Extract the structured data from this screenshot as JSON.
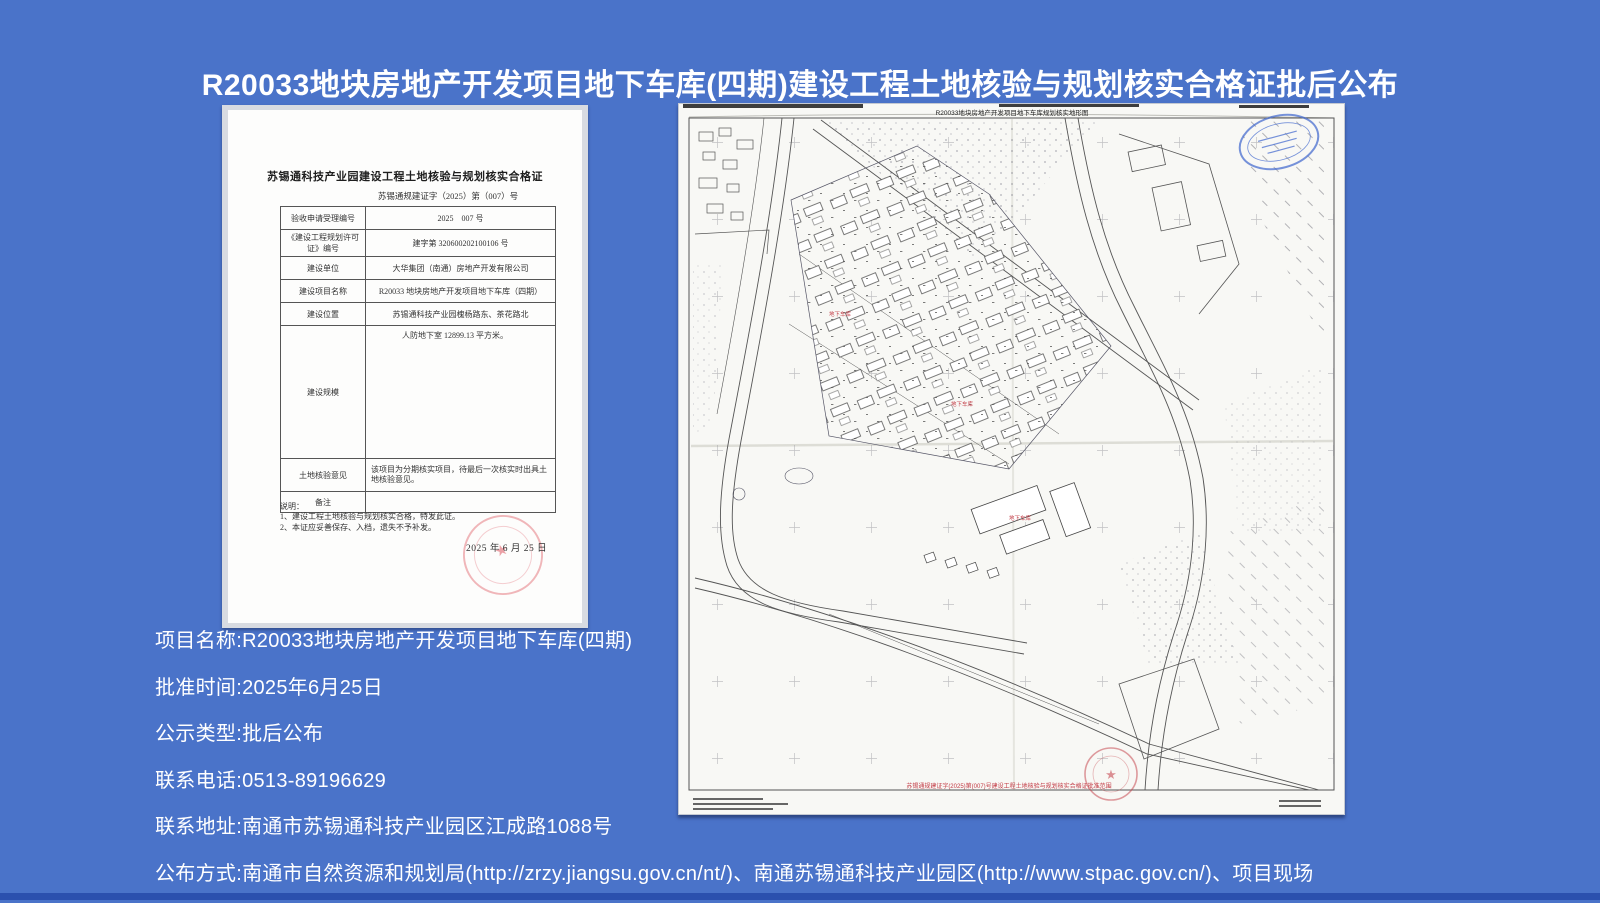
{
  "page": {
    "title": "R20033地块房地产开发项目地下车库(四期)建设工程土地核验与规划核实合格证批后公布",
    "background_color": "#4a73c9",
    "title_color": "#ffffff"
  },
  "certificate": {
    "title": "苏锡通科技产业园建设工程土地核验与规划核实合格证",
    "doc_number": "苏锡通规建证字（2025）第（007）号",
    "rows": [
      {
        "label": "验收申请受理编号",
        "value": "2025　007 号"
      },
      {
        "label": "《建设工程规划许可证》编号",
        "value": "建字第 320600202100106 号"
      },
      {
        "label": "建设单位",
        "value": "大华集团（南通）房地产开发有限公司"
      },
      {
        "label": "建设项目名称",
        "value": "R20033 地块房地产开发项目地下车库（四期）"
      },
      {
        "label": "建设位置",
        "value": "苏锡通科技产业园槐杨路东、茶花路北"
      },
      {
        "label": "建设规模",
        "value": "人防地下室 12899.13 平方米。"
      },
      {
        "label": "土地核验意见",
        "value": "该项目为分期核实项目，待最后一次核实时出具土地核验意见。"
      },
      {
        "label": "备注",
        "value": ""
      }
    ],
    "notes_title": "说明：",
    "notes": [
      "1、建设工程土地核验与规划核实合格，特发此证。",
      "2、本证应妥善保存、入档，遗失不予补发。"
    ],
    "date": "2025 年 6 月 25 日",
    "stamp_color": "#dc5f69"
  },
  "map": {
    "title": "R20033地块房地产开发项目地下车库规划核实地形图",
    "garage_label": "地下车库",
    "red_note": "苏锡通规建证字(2025)第(007)号建设工程土地核验与规划核实合格证批准范围",
    "red_stamp_color": "#c74a52",
    "blue_stamp_color": "#4a6fd0"
  },
  "details": [
    {
      "label": "项目名称:",
      "value": "R20033地块房地产开发项目地下车库(四期)"
    },
    {
      "label": "批准时间:",
      "value": "2025年6月25日"
    },
    {
      "label": "公示类型:",
      "value": "批后公布"
    },
    {
      "label": "联系电话:",
      "value": "0513-89196629"
    },
    {
      "label": "联系地址:",
      "value": "南通市苏锡通科技产业园区江成路1088号"
    },
    {
      "label": "公布方式:",
      "value": "南通市自然资源和规划局(http://zrzy.jiangsu.gov.cn/nt/)、南通苏锡通科技产业园区(http://www.stpac.gov.cn/)、项目现场"
    }
  ]
}
